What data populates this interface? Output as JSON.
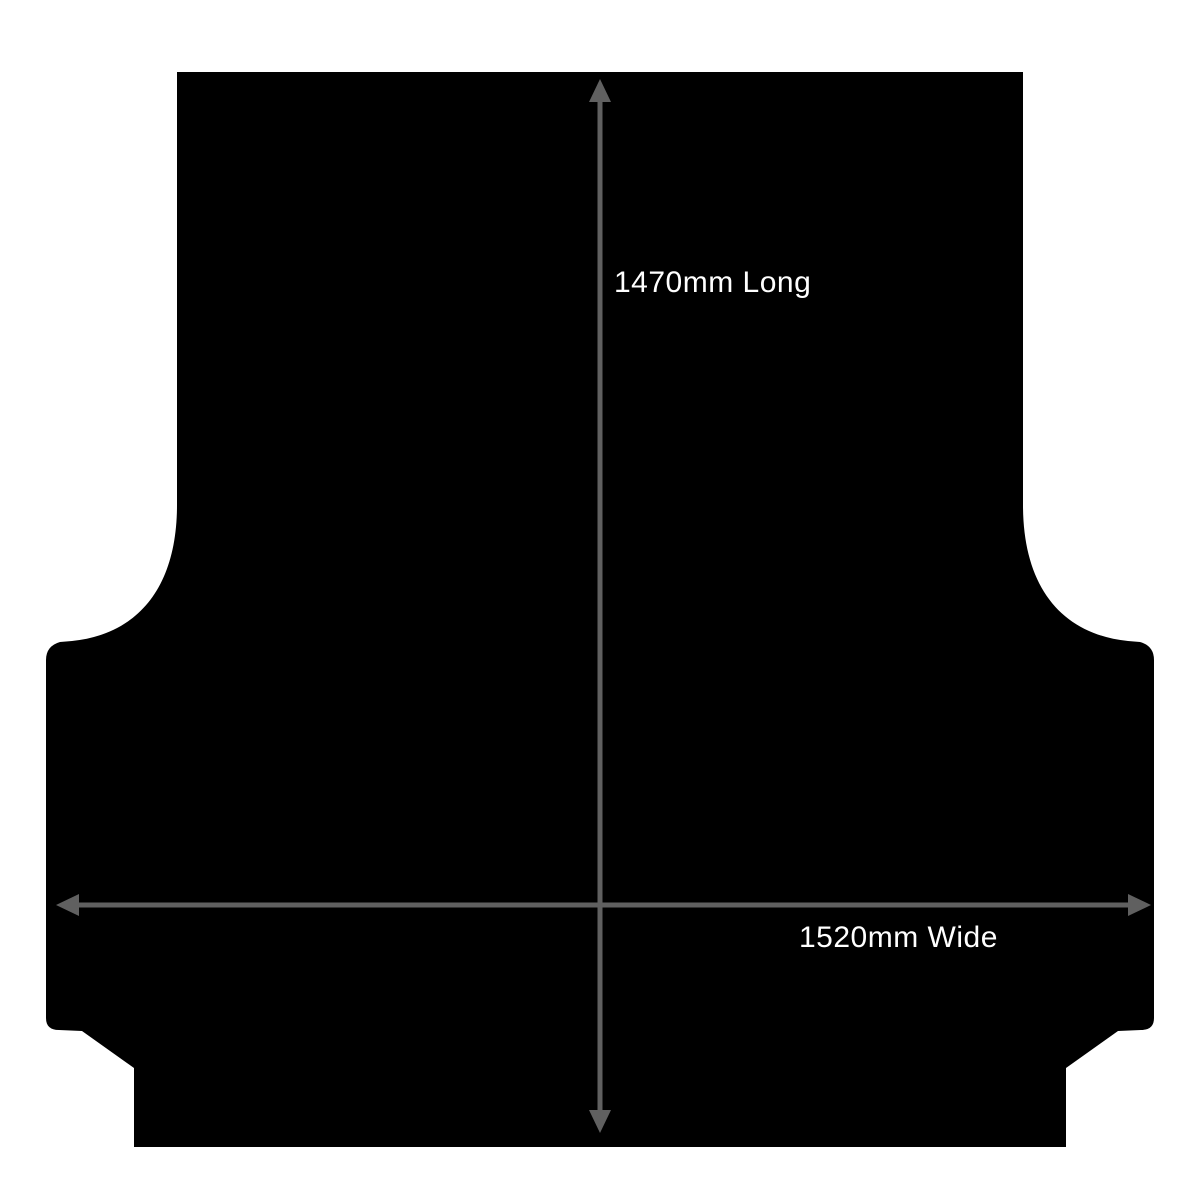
{
  "annotations": {
    "length": {
      "label": "1470mm Long",
      "value_mm": 1470,
      "orientation": "vertical"
    },
    "width": {
      "label": "1520mm Wide",
      "value_mm": 1520,
      "orientation": "horizontal"
    }
  },
  "colors": {
    "background": "#ffffff",
    "silhouette": "#000000",
    "arrow": "#606060",
    "label_text": "#ffffff"
  }
}
